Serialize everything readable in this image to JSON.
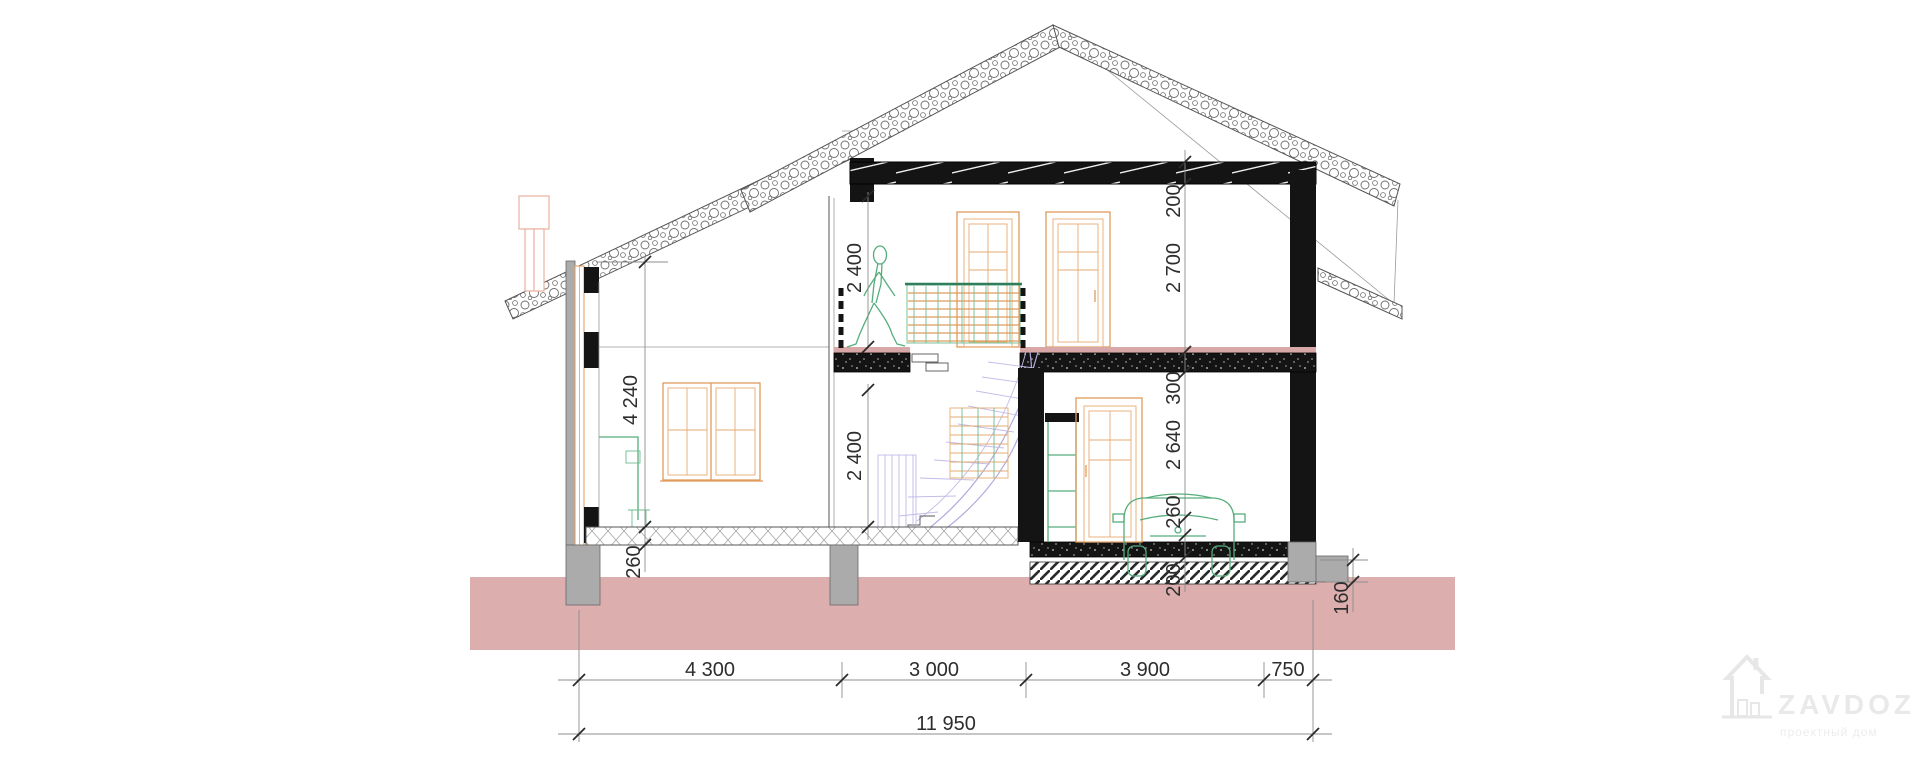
{
  "meta": {
    "title": "House cross-section drawing"
  },
  "colors": {
    "ground": "#dcaeae",
    "structure_fill": "#141414",
    "timber_orange": "#e09a5a",
    "fixture_green": "#55ad7c",
    "stair_purple": "#b3a8de",
    "slab_pink": "#d8a8a8",
    "foundation_gray": "#ababab",
    "dimension_text": "#2d2d2d"
  },
  "dims": {
    "wall_height": "4 240",
    "floor_slab": "260",
    "upper_clearance": "2 400",
    "lower_clearance": "2 400",
    "right_chain": [
      "200",
      "2 700",
      "300",
      "2 640",
      "260"
    ],
    "garage_slab": "200",
    "footing_depth": "160",
    "bottom_chain": [
      "4 300",
      "3 000",
      "3 900",
      "750"
    ],
    "overall_width": "11 950"
  },
  "watermark": {
    "brand": "ZAVDOZ",
    "tagline": "проектный дом"
  }
}
